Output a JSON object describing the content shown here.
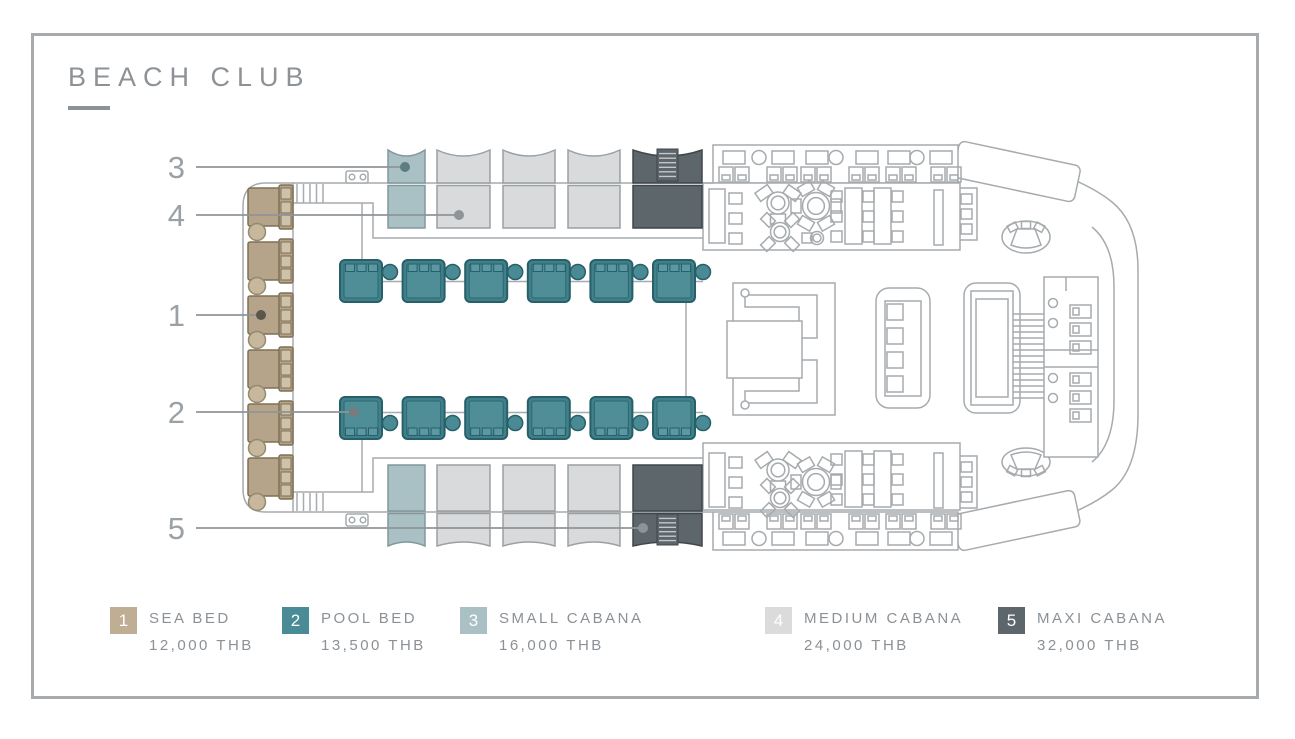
{
  "title": "BEACH CLUB",
  "legend": {
    "items": [
      {
        "number": "1",
        "label": "SEA BED",
        "price": "12,000 THB",
        "color": "#bfae93"
      },
      {
        "number": "2",
        "label": "POOL BED",
        "price": "13,500 THB",
        "color": "#4a8c95"
      },
      {
        "number": "3",
        "label": "SMALL CABANA",
        "price": "16,000 THB",
        "color": "#a9c1c5"
      },
      {
        "number": "4",
        "label": "MEDIUM CABANA",
        "price": "24,000 THB",
        "color": "#dbdbdc"
      },
      {
        "number": "5",
        "label": "MAXI CABANA",
        "price": "32,000 THB",
        "color": "#5d666b"
      }
    ]
  },
  "callouts": [
    {
      "number": "3",
      "target": "small-cabana"
    },
    {
      "number": "4",
      "target": "medium-cabana"
    },
    {
      "number": "1",
      "target": "sea-bed"
    },
    {
      "number": "2",
      "target": "pool-bed"
    },
    {
      "number": "5",
      "target": "maxi-cabana"
    }
  ],
  "floorplan": {
    "sea_bed_count": 6,
    "pool_bed_count": 12,
    "small_cabana_count": 2,
    "medium_cabana_count": 6,
    "maxi_cabana_count": 2
  },
  "colors": {
    "outline": "#a6abae",
    "frame": "#a7abad",
    "text": "#8b9196",
    "sea_bed": "#b5a48a",
    "pool_bed": "#4a8c95",
    "small_cabana": "#a9c1c5",
    "medium_cabana": "#d9dadb",
    "maxi_cabana": "#5d666b"
  }
}
